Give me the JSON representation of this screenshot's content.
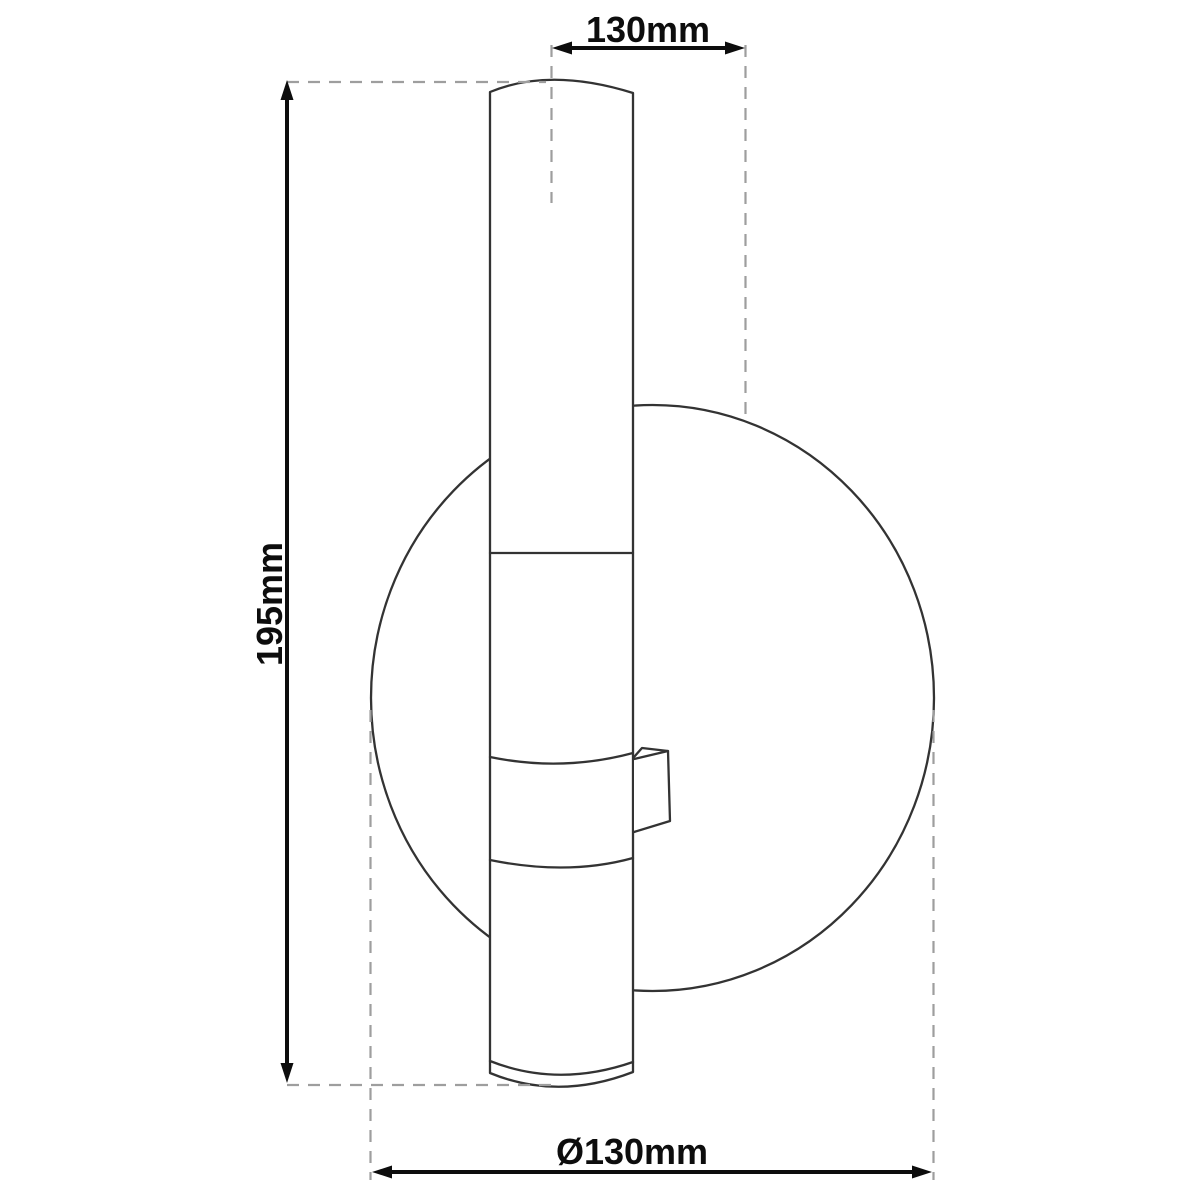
{
  "drawing": {
    "labels": {
      "width_top": "130mm",
      "height_left": "195mm",
      "diameter_bottom": "Ø130mm"
    },
    "colors": {
      "outline": "#333333",
      "dimension": "#0d0d0d",
      "dashed": "#9e9e9e",
      "background": "#ffffff"
    }
  }
}
